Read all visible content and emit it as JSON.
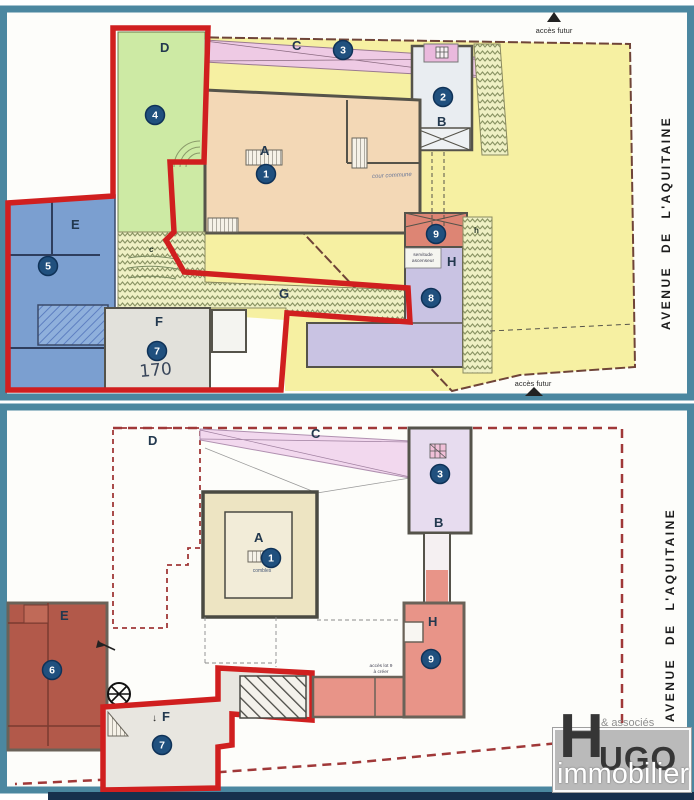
{
  "top": {
    "letters": {
      "A": "A",
      "B": "B",
      "C": "C",
      "D": "D",
      "E": "E",
      "F": "F",
      "G": "G",
      "H": "H",
      "c": "c",
      "h": "h"
    },
    "lots": {
      "1": "1",
      "2": "2",
      "3": "3",
      "4": "4",
      "5": "5",
      "7": "7",
      "8": "8",
      "9": "9"
    },
    "acces_futur_top": "accès futur",
    "acces_futur_bottom": "accès futur",
    "cour_commune": "cour commune",
    "servitude_line1": "servitude",
    "servitude_line2": "ascenseur",
    "note_170": "170",
    "street": "AVENUE DE L'AQUITAINE"
  },
  "bottom": {
    "letters": {
      "A": "A",
      "B": "B",
      "C": "C",
      "D": "D",
      "E": "E",
      "F": "F",
      "H": "H"
    },
    "lots": {
      "1": "1",
      "3": "3",
      "6": "6",
      "7": "7",
      "9": "9"
    },
    "combles": "combles",
    "acces_lot9_line1": "accès lot 9",
    "acces_lot9_line2": "à créer",
    "street": "AVENUE DE L'AQUITAINE"
  },
  "logo": {
    "associes": "& associés",
    "h": "H",
    "ugo": "UGO",
    "immobilier": "immobilier"
  },
  "colors": {
    "frame_teal": "#4b87a0",
    "red_outline": "#d01f1f",
    "boundary_brown": "#8a3a32",
    "parcel_yellow": "#f6f0a2",
    "garden_green": "#cdeaa4",
    "corridor_pink": "#eecae4",
    "building_peach": "#f3d8b6",
    "zone_blue": "#7b9fd0",
    "zone_gray": "#e2e1db",
    "zone_salmon": "#dd8574",
    "zone_lavender": "#c9c3e3",
    "zone_terracotta": "#b2594a",
    "zone_beige": "#ede4c2",
    "lot_circle_blue": "#20507e",
    "logo_gray": "#bababa",
    "bottom_bar_navy": "#17304d"
  }
}
